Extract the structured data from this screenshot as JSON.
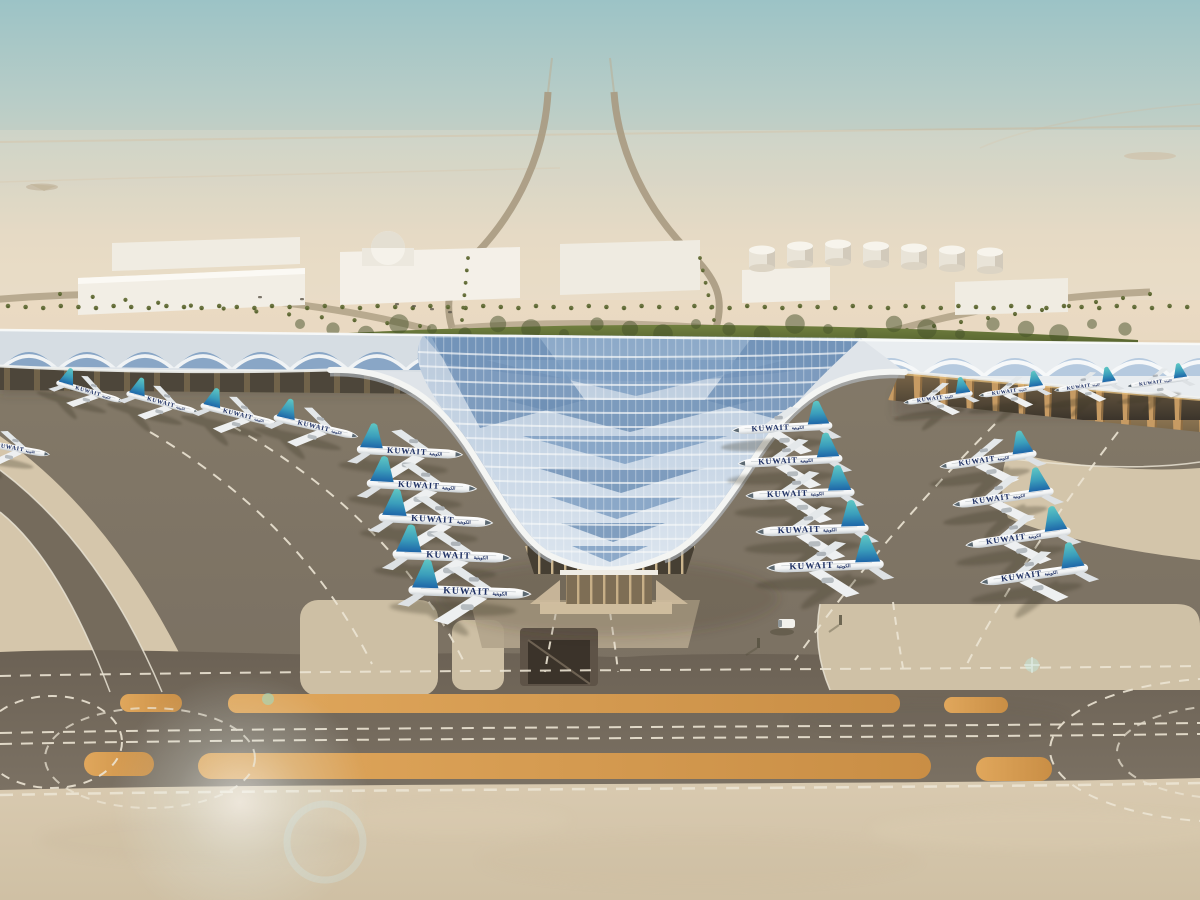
{
  "scene": {
    "subject": "aerial-render-kuwait-airport-terminal",
    "aircraft_label": "KUWAIT",
    "aircraft_label_arabic": "الكويتية"
  },
  "palette": {
    "sky_top": "#9cc3c6",
    "sky_mid": "#cdd0c2",
    "sky_horizon": "#e9dcc6",
    "sand_far": "#e7d6bd",
    "sand_near": "#d6c7ab",
    "apron_dark": "#7a7062",
    "apron_darker": "#6b6154",
    "roof_white": "#f4f5f3",
    "roof_silver": "#dfe4e9",
    "solar_blue": "#7b9cc1",
    "solar_blue_dark": "#6d8fb5",
    "solar_blue_light": "#a9c2db",
    "hedge_green": "#5f6d33",
    "palm_green": "#6b7440",
    "marking_white": "#ece5d4",
    "marking_orange_1": "#e0a75c",
    "marking_orange_2": "#c98e45",
    "tail_teal": "#5fc7c4",
    "tail_blue": "#1e66a8",
    "title_navy": "#1d2f63",
    "building_white": "#f3efe7",
    "arcade_tan": "#c79b63"
  },
  "aircraft": {
    "label": "KUWAIT",
    "label_arabic": "الكويتية",
    "count": 23,
    "fleet": [
      {
        "group": "left-wing",
        "x": 12,
        "y": 448,
        "s": 0.55,
        "dir": 1,
        "rot": 10
      },
      {
        "group": "left-wing",
        "x": 90,
        "y": 392,
        "s": 0.5,
        "dir": 1,
        "rot": 16
      },
      {
        "group": "left-wing",
        "x": 163,
        "y": 403,
        "s": 0.54,
        "dir": 1,
        "rot": 15
      },
      {
        "group": "left-wing",
        "x": 240,
        "y": 415,
        "s": 0.58,
        "dir": 1,
        "rot": 14
      },
      {
        "group": "left-wing",
        "x": 316,
        "y": 427,
        "s": 0.62,
        "dir": 1,
        "rot": 13
      },
      {
        "group": "left-stack",
        "x": 410,
        "y": 452,
        "s": 0.76,
        "dir": 1,
        "rot": 3
      },
      {
        "group": "left-stack",
        "x": 422,
        "y": 486,
        "s": 0.79,
        "dir": 1,
        "rot": 3
      },
      {
        "group": "left-stack",
        "x": 436,
        "y": 520,
        "s": 0.82,
        "dir": 1,
        "rot": 3
      },
      {
        "group": "left-stack",
        "x": 452,
        "y": 556,
        "s": 0.85,
        "dir": 1,
        "rot": 2
      },
      {
        "group": "left-stack",
        "x": 470,
        "y": 592,
        "s": 0.88,
        "dir": 1,
        "rot": 2
      },
      {
        "group": "right-inner",
        "x": 782,
        "y": 428,
        "s": 0.72,
        "dir": -1,
        "rot": -3
      },
      {
        "group": "right-inner",
        "x": 790,
        "y": 461,
        "s": 0.75,
        "dir": -1,
        "rot": -3
      },
      {
        "group": "right-inner",
        "x": 800,
        "y": 494,
        "s": 0.78,
        "dir": -1,
        "rot": -2
      },
      {
        "group": "right-inner",
        "x": 812,
        "y": 530,
        "s": 0.81,
        "dir": -1,
        "rot": -2
      },
      {
        "group": "right-inner",
        "x": 825,
        "y": 566,
        "s": 0.84,
        "dir": -1,
        "rot": -2
      },
      {
        "group": "right-outer",
        "x": 988,
        "y": 460,
        "s": 0.7,
        "dir": -1,
        "rot": -8
      },
      {
        "group": "right-outer",
        "x": 1003,
        "y": 498,
        "s": 0.73,
        "dir": -1,
        "rot": -8
      },
      {
        "group": "right-outer",
        "x": 1018,
        "y": 538,
        "s": 0.76,
        "dir": -1,
        "rot": -8
      },
      {
        "group": "right-outer",
        "x": 1034,
        "y": 575,
        "s": 0.78,
        "dir": -1,
        "rot": -8
      },
      {
        "group": "right-wing",
        "x": 938,
        "y": 398,
        "s": 0.5,
        "dir": -1,
        "rot": -8
      },
      {
        "group": "right-wing",
        "x": 1012,
        "y": 391,
        "s": 0.48,
        "dir": -1,
        "rot": -8
      },
      {
        "group": "right-wing",
        "x": 1086,
        "y": 386,
        "s": 0.46,
        "dir": -1,
        "rot": -8
      },
      {
        "group": "right-wing",
        "x": 1158,
        "y": 382,
        "s": 0.45,
        "dir": -1,
        "rot": -8
      }
    ]
  },
  "ground": {
    "fuel_tanks_count": 7,
    "orange_strip_rows": 2,
    "service_vehicles": 1
  }
}
